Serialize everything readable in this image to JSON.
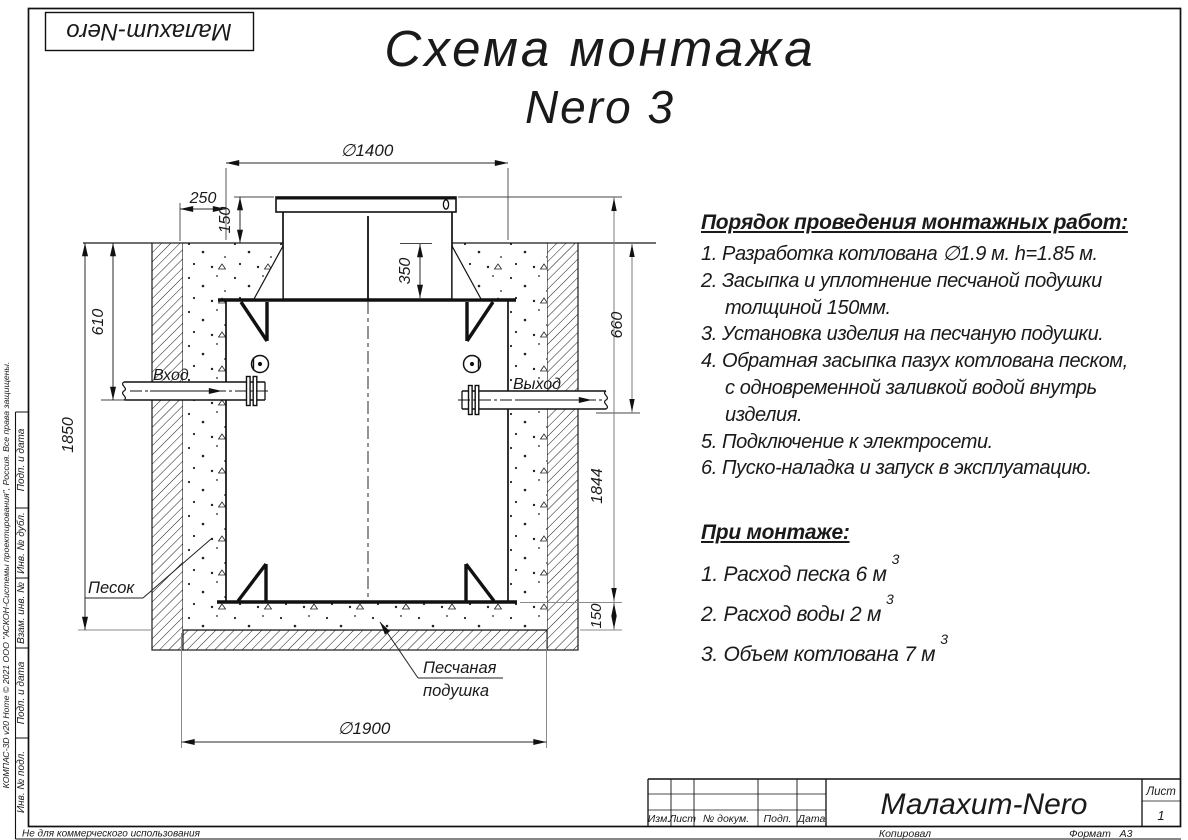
{
  "sheet": {
    "frame_stamp": "Малахит-Nero",
    "copyright": "КОМПАС-3D v20 Home © 2021 ООО \"АСКОН-Системы проектирования\", Россия. Все права защищены.",
    "non_commercial": "Не для коммерческого использования",
    "margin_cells": {
      "c1": "Подп. и дата",
      "c2": "Инв. № дубл.",
      "c3": "Взам. инв. №",
      "c4": "Подп. и дата",
      "c5": "Инв. № подл."
    }
  },
  "title": {
    "line1": "Схема монтажа",
    "line2": "Nero 3"
  },
  "procedure": {
    "heading": "Порядок проведения монтажных работ:",
    "items": [
      "1. Разработка котлована ∅1.9 м. h=1.85 м.",
      "2. Засыпка и уплотнение песчаной подушки\nтолщиной 150мм.",
      "3. Установка изделия на песчаную подушки.",
      "4. Обратная засыпка пазух котлована песком,\nс одновременной заливкой водой внутрь\nизделия.",
      "5. Подключение к электросети.",
      "6. Пуско-наладка и запуск в эксплуатацию."
    ]
  },
  "montage": {
    "heading": "При монтаже:",
    "items": [
      {
        "text": "1. Расход песка 6 м",
        "sup": "3"
      },
      {
        "text": "2. Расход воды 2 м",
        "sup": "3"
      },
      {
        "text": "3. Объем котлована 7 м",
        "sup": "3"
      }
    ]
  },
  "drawing": {
    "dims": {
      "top_diameter": "∅1400",
      "offset": "250",
      "lid_height": "150",
      "neck_depth": "350",
      "inlet_depth": "610",
      "pit_depth": "1850",
      "outlet_depth": "660",
      "body_height": "1844",
      "cushion_thickness": "150",
      "pit_diameter": "∅1900"
    },
    "labels": {
      "inlet": "Вход",
      "outlet": "Выход",
      "sand": "Песок",
      "cushion_line1": "Песчаная",
      "cushion_line2": "подушка"
    }
  },
  "title_block": {
    "col_headers": {
      "h1": "Изм.",
      "h2": "Лист",
      "h3": "№ докум.",
      "h4": "Подп.",
      "h5": "Дата"
    },
    "product": "Малахит-Nero",
    "sheet_label": "Лист",
    "sheet_number": "1",
    "copied": "Копировал",
    "format_label": "Формат",
    "format_value": "А3"
  }
}
